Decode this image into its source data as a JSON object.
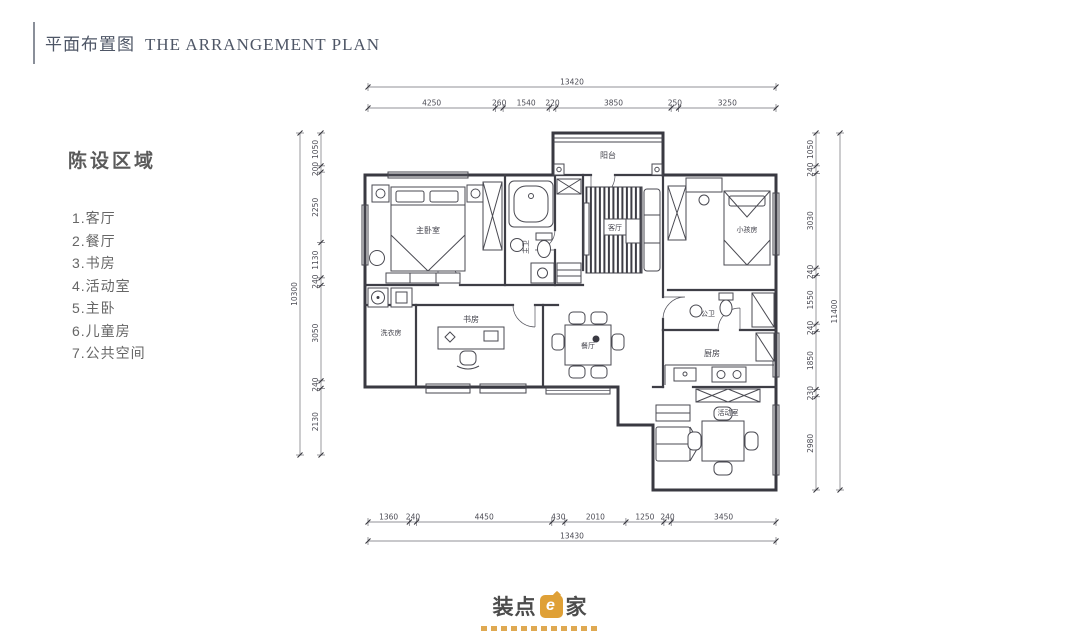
{
  "header": {
    "title_zh": "平面布置图",
    "title_en": "THE ARRANGEMENT PLAN"
  },
  "legend": {
    "title": "陈设区域",
    "items": [
      "1.客厅",
      "2.餐厅",
      "3.书房",
      "4.活动室",
      "5.主卧",
      "6.儿童房",
      "7.公共空间"
    ]
  },
  "plan": {
    "room_labels": {
      "master_bedroom": "主卧室",
      "master_bath": "主卫",
      "balcony": "阳台",
      "living": "客厅",
      "kids_room": "小孩房",
      "public_bath": "公卫",
      "kitchen": "厨房",
      "dining": "餐厅",
      "study": "书房",
      "laundry": "洗衣房",
      "activity": "活动室"
    },
    "dim_chains": {
      "top_total": [
        "13420"
      ],
      "top": [
        "4250",
        "260",
        "1540",
        "220",
        "3850",
        "250",
        "3250"
      ],
      "bottom": [
        "1360",
        "240",
        "4450",
        "430",
        "2010",
        "1250",
        "240",
        "3450"
      ],
      "bottom_total": [
        "13430"
      ],
      "left": [
        "1050",
        "200",
        "2250",
        "1130",
        "240",
        "3050",
        "240",
        "2130"
      ],
      "left_total": [
        "10300"
      ],
      "right": [
        "1050",
        "240",
        "3030",
        "240",
        "1550",
        "240",
        "1850",
        "230",
        "2980"
      ],
      "right_total": [
        "11400"
      ]
    }
  },
  "logo": {
    "part1": "装点",
    "e": "e",
    "part2": "家"
  },
  "colors": {
    "accent_orange": "#dfa036",
    "line": "#393941",
    "title_text": "#4e5666"
  }
}
